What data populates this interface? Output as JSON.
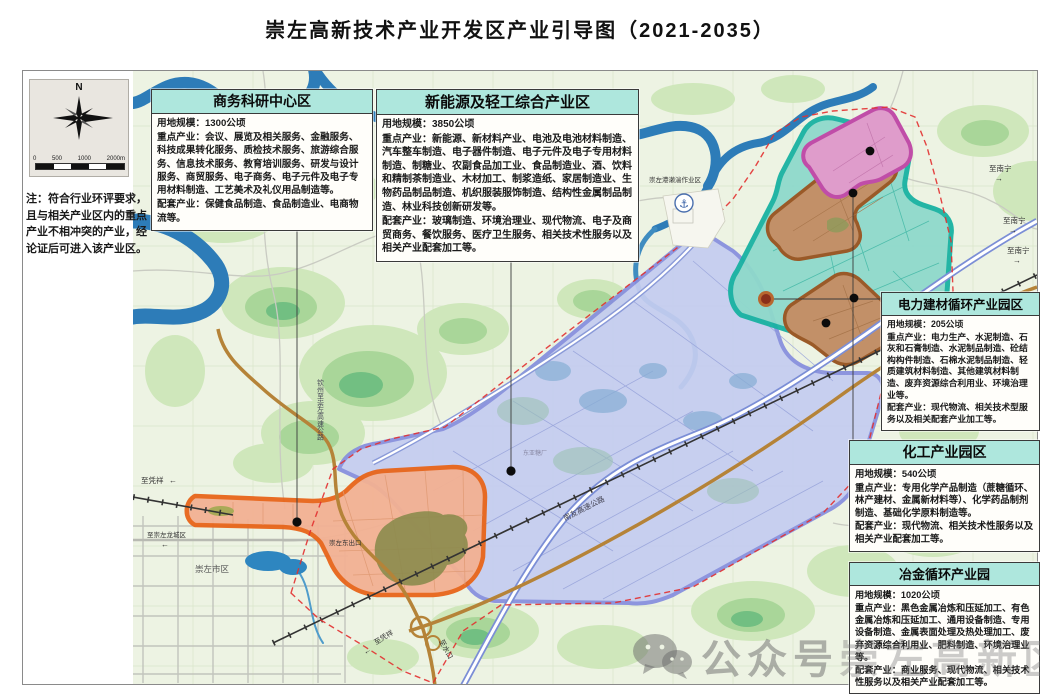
{
  "title": "崇左高新技术产业开发区产业引导图（2021-2035）",
  "note": "注：符合行业环评要求，且与相关产业区内的重点产业不相冲突的产业，经论证后可进入该产业区。",
  "compass": {
    "north": "N",
    "scale_ticks": [
      "0",
      "500",
      "1000",
      "2000m"
    ]
  },
  "info_boxes": [
    {
      "title": "商务科研中心区",
      "land": "用地规模：1300公顷",
      "key": "重点产业：会议、展览及相关服务、金融服务、科技成果转化服务、质检技术服务、旅游综合服务、信息技术服务、教育培训服务、研发与设计服务、商贸服务、电子商务、电子元件及电子专用材料制造、工艺美术及礼仪用品制造等。",
      "support": "配套产业：保健食品制造、食品制造业、电商物流等。"
    },
    {
      "title": "新能源及轻工综合产业区",
      "land": "用地规模：3850公顷",
      "key": "重点产业：新能源、新材料产业、电池及电池材料制造、汽车整车制造、电子器件制造、电子元件及电子专用材料制造、制糖业、农副食品加工业、食品制造业、酒、饮料和精制茶制造业、木材加工、制浆造纸、家居制造业、生物药品制品制造、机织服装服饰制造、结构性金属制品制造、林业科技创新研发等。",
      "support": "配套产业：玻璃制造、环境治理业、现代物流、电子及商贸商务、餐饮服务、医疗卫生服务、相关技术性服务以及相关产业配套加工等。"
    },
    {
      "title": "电力建材循环产业园区",
      "land": "用地规模：205公顷",
      "key": "重点产业：电力生产、水泥制造、石灰和石膏制造、水泥制品制造、砼结构构件制造、石棉水泥制品制造、轻质建筑材料制造、其他建筑材料制造、废弃资源综合利用业、环境治理业等。",
      "support": "配套产业：现代物流、相关技术型服务以及相关配套产业加工等。"
    },
    {
      "title": "化工产业园区",
      "land": "用地规模：540公顷",
      "key": "重点产业：专用化学产品制造（蔗糖循环、林产建材、金属新材料等）、化学药品制剂制造、基础化学原料制造等。",
      "support": "配套产业：现代物流、相关技术性服务以及相关产业配套加工等。"
    },
    {
      "title": "冶金循环产业园",
      "land": "用地规模：1020公顷",
      "key": "重点产业：黑色金属冶炼和压延加工、有色金属冶炼和压延加工、通用设备制造、专用设备制造、金属表面处理及热处理加工、废弃资源综合利用业、肥料制造、环境治理业等。",
      "support": "配套产业：商业服务、现代物流、相关技术性服务以及相关产业配套加工等。"
    }
  ],
  "map_labels": {
    "port": "崇左港濑湍作业区",
    "city": "崇左市区",
    "to_pingxiang_west": "至凭祥",
    "to_longcheng": "至崇左龙城区",
    "east_exit": "崇左东出口",
    "sugar_factory": "东亚糖厂",
    "nanyou_expressway": "南友高速公路",
    "qinzhou_expressway": "钦州至崇左高速公路",
    "to_nanning": "至南宁",
    "to_pingxiang_south": "至凭祥",
    "to_shuikou": "至水口"
  },
  "watermark": {
    "account": "公众号",
    "ghost": "崇左高新区"
  },
  "colors": {
    "zone_business_rd": "#e8651a",
    "zone_new_energy": "#868ede",
    "zone_power_building_cluster": "#19b2a2",
    "zone_chemical_pink": "#c04da8",
    "zone_brown": "#9a5a28",
    "boundary_dashed": "#e23030",
    "box_header": "#aee7dd",
    "river": "#2d7cb8",
    "map_base": "#edf3e3"
  }
}
